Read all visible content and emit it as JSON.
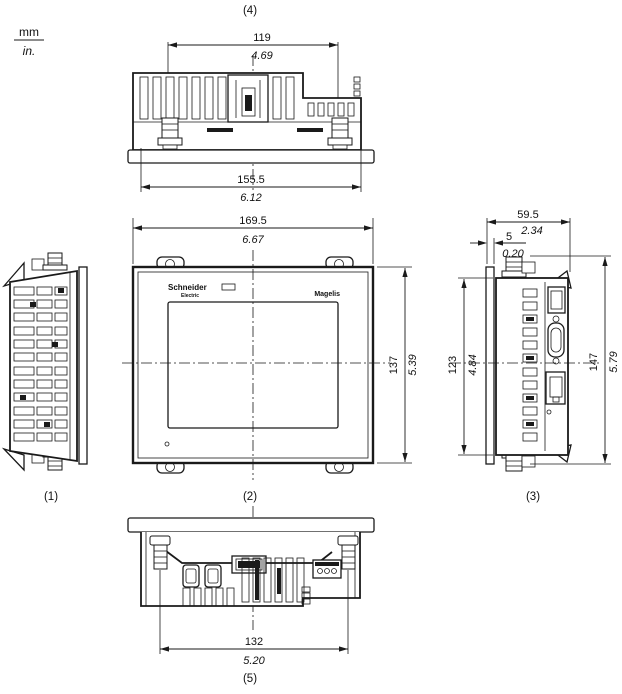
{
  "page": {
    "background": "#ffffff",
    "line_color": "#1a1a1a"
  },
  "units_legend": {
    "mm": "mm",
    "inch": "in."
  },
  "view_labels": {
    "left": "(1)",
    "front": "(2)",
    "right": "(3)",
    "top": "(4)",
    "bottom": "(5)"
  },
  "branding": {
    "logo_line1": "Schneider",
    "logo_line2": "Electric",
    "product": "Magelis"
  },
  "dims": {
    "top_mounting_pitch": {
      "mm": "119",
      "inch": "4.69"
    },
    "top_overall_width": {
      "mm": "155.5",
      "inch": "6.12"
    },
    "front_width": {
      "mm": "169.5",
      "inch": "6.67"
    },
    "front_height": {
      "mm": "137",
      "inch": "5.39"
    },
    "side_depth": {
      "mm": "59.5",
      "inch": "2.34"
    },
    "bezel_thickness": {
      "mm": "5",
      "inch": "0.20"
    },
    "side_body_height": {
      "mm": "123",
      "inch": "4.84"
    },
    "side_overall_height": {
      "mm": "147",
      "inch": "5.79"
    },
    "bottom_mounting_pitch": {
      "mm": "132",
      "inch": "5.20"
    }
  }
}
